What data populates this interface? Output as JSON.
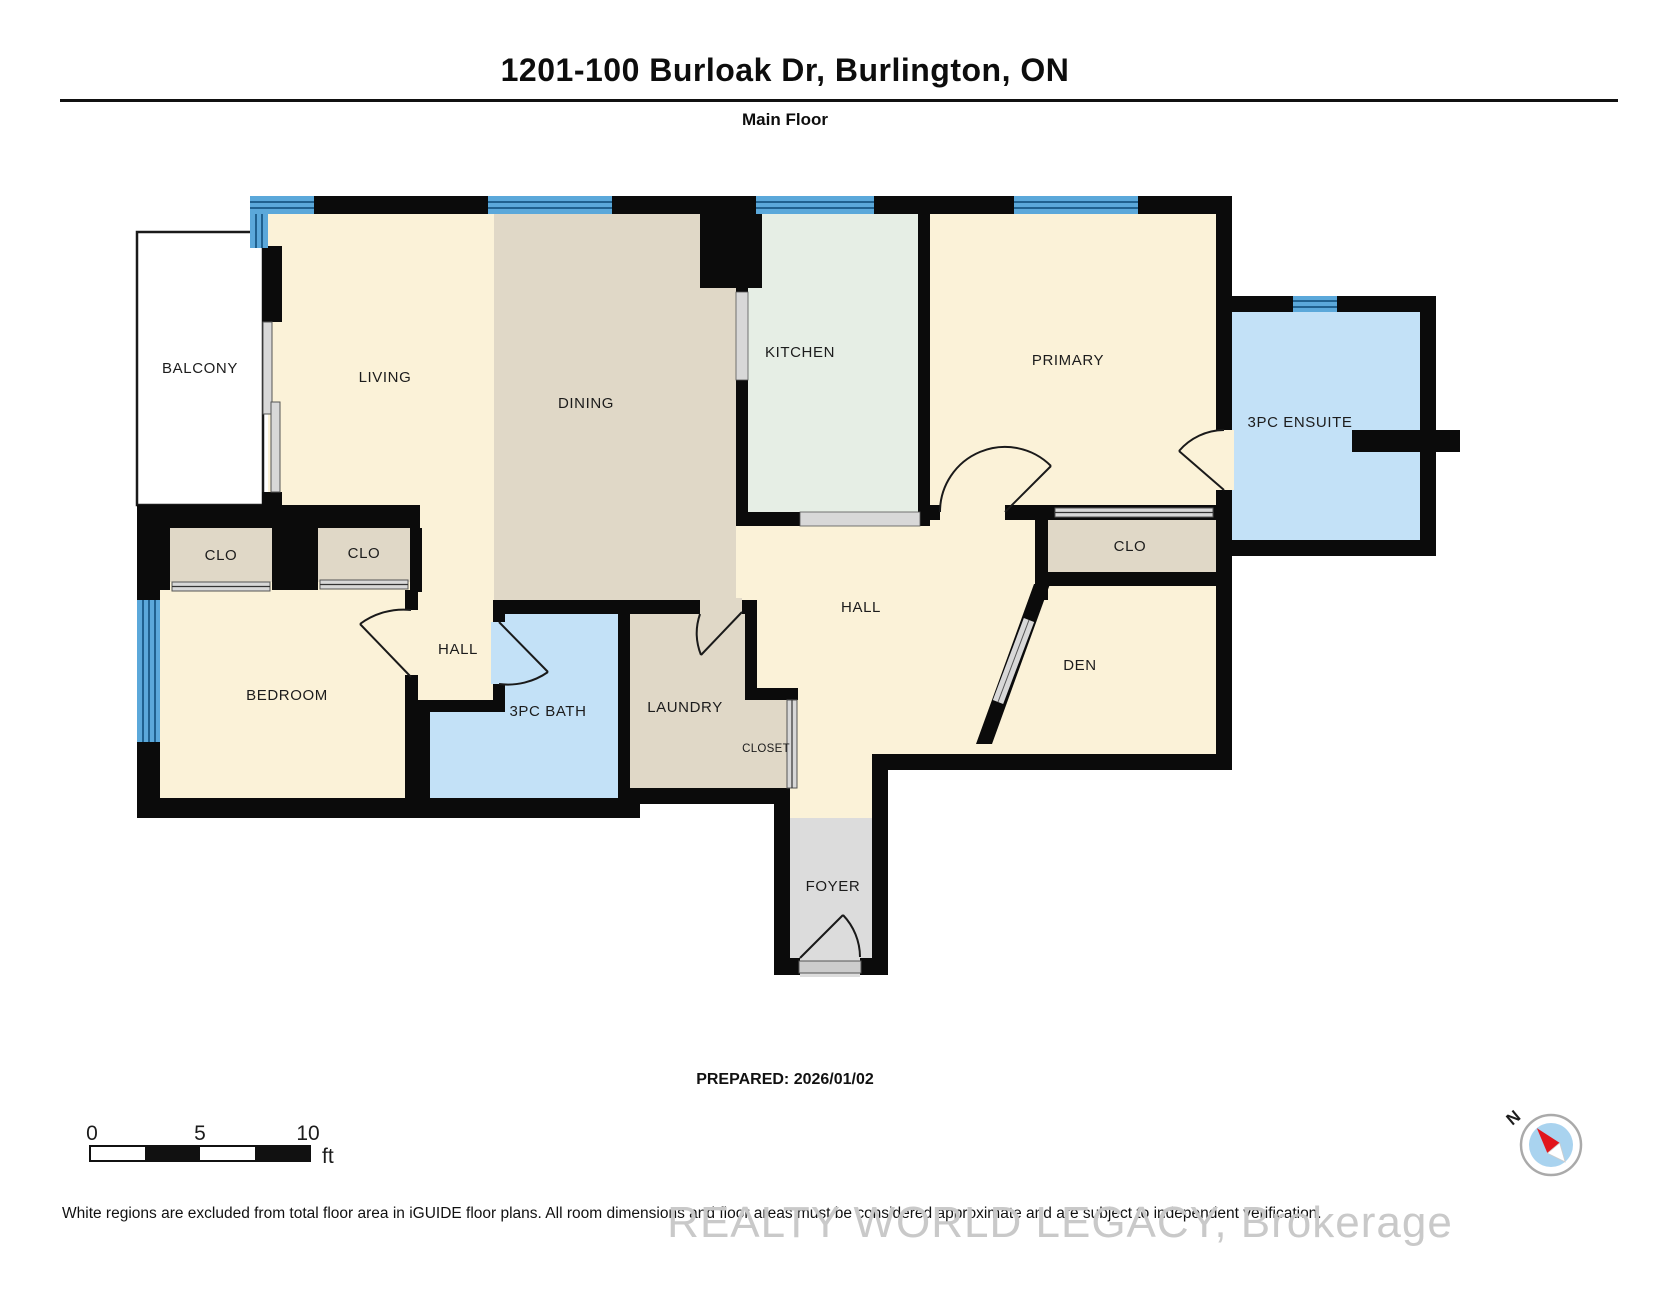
{
  "header": {
    "title": "1201-100 Burloak Dr, Burlington, ON",
    "subtitle": "Main Floor"
  },
  "rooms": {
    "balcony": "BALCONY",
    "living": "LIVING",
    "dining": "DINING",
    "kitchen": "KITCHEN",
    "primary": "PRIMARY",
    "ensuite": "3PC ENSUITE",
    "clo_left": "CLO",
    "clo_mid": "CLO",
    "clo_right": "CLO",
    "hall_upper": "HALL",
    "hall_main": "HALL",
    "bedroom": "BEDROOM",
    "bath": "3PC BATH",
    "laundry": "LAUNDRY",
    "closet": "CLOSET",
    "den": "DEN",
    "foyer": "FOYER"
  },
  "scale_bar": {
    "tick_0": "0",
    "tick_5": "5",
    "tick_10": "10",
    "unit": "ft"
  },
  "compass": {
    "north_label": "N"
  },
  "footer": {
    "prepared": "PREPARED: 2026/01/02",
    "disclaimer": "White regions are excluded from total floor area in iGUIDE floor plans. All room dimensions and floor areas must be considered approximate and are subject to independent verification.",
    "watermark": "REALTY WORLD LEGACY, Brokerage"
  },
  "colors": {
    "wall": "#0b0b0b",
    "room_cream": "#fbf2d8",
    "room_tan": "#e0d8c7",
    "room_kitchen": "#e6eee5",
    "room_blue": "#c3e1f7",
    "window_blue": "#5ba8da",
    "window_stripe": "#20618f",
    "foyer_gray": "#dcdcdc",
    "slider_gray": "#d8d8d8",
    "compass_red": "#e1151b",
    "compass_blue": "#a9d3ef"
  }
}
